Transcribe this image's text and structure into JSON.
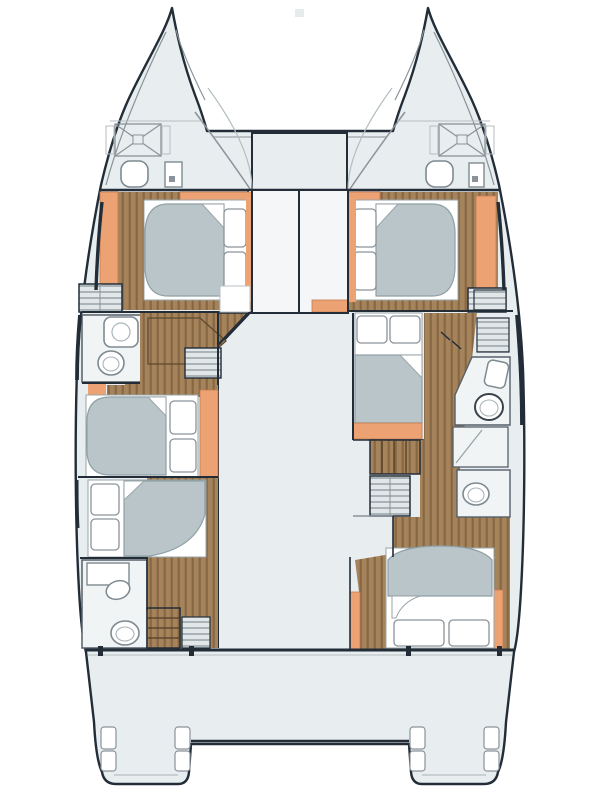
{
  "document": {
    "kind": "catamaran-deck-plan",
    "title": ""
  },
  "palette": {
    "line": "#222d38",
    "hull": "#e8edef",
    "room": "#f1f4f5",
    "white": "#ffffff",
    "wood": "#a5845c",
    "woodDark": "#876744",
    "orange": "#eda273",
    "orangeEdge": "#c07c4e",
    "duvet": "#b9c5c9",
    "duvetEdge": "#8fa0a6",
    "fixEdge": "#7d8a91",
    "louvA": "#e1e6e8",
    "louvB": "#aab4b8",
    "mid": "#8a9399",
    "faint": "#e6ebec"
  },
  "inventory": {
    "double_beds": 6,
    "toilets": 6,
    "sinks": 4,
    "stairways": 2,
    "bow_hatches": 2,
    "louvered_lockers": 6,
    "transom_platforms": 2
  }
}
